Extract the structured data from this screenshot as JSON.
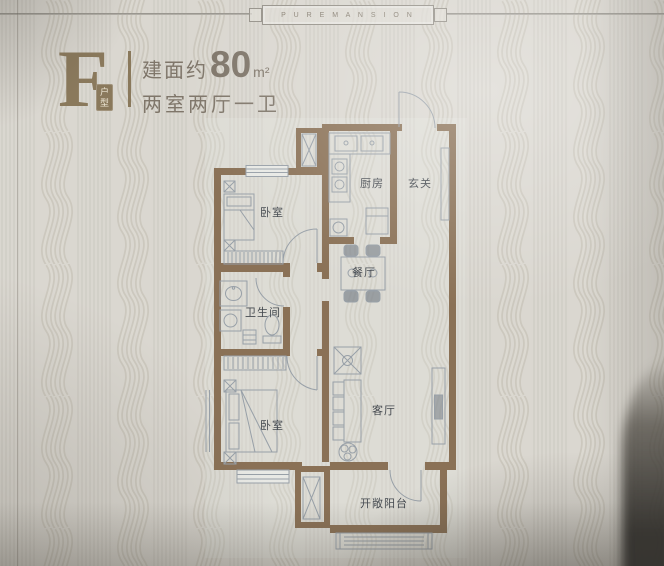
{
  "banner": {
    "brand": "P U R E M A N S I O N"
  },
  "header": {
    "type_letter": "F",
    "type_badge_chars": [
      "户",
      "型"
    ],
    "area_prefix": "建面约",
    "area_value": "80",
    "area_unit": "m²",
    "layout": "两室两厅一卫"
  },
  "floorplan": {
    "rooms": [
      {
        "id": "bedroom-1",
        "label": "卧室"
      },
      {
        "id": "kitchen",
        "label": "厨房"
      },
      {
        "id": "foyer",
        "label": "玄关"
      },
      {
        "id": "dining",
        "label": "餐厅"
      },
      {
        "id": "bathroom",
        "label": "卫生间"
      },
      {
        "id": "bedroom-2",
        "label": "卧室"
      },
      {
        "id": "living-room",
        "label": "客厅"
      },
      {
        "id": "balcony",
        "label": "开敞阳台"
      }
    ],
    "colors": {
      "wall": "#8a7156",
      "line": "#98a0a8",
      "label": "#454a50",
      "accent": "#8a795c"
    }
  }
}
